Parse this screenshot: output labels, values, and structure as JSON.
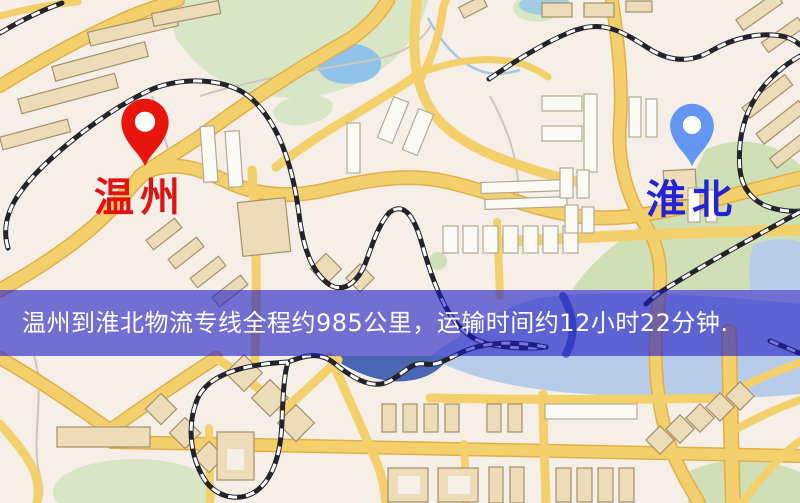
{
  "map": {
    "pins": {
      "origin": {
        "label": "温州",
        "label_color": "#e21212",
        "pin_color": "#e9140c"
      },
      "destination": {
        "label": "淮北",
        "label_color": "#2424d6",
        "pin_color": "#6495f1"
      }
    },
    "banner": {
      "text": "温州到淮北物流专线全程约985公里，运输时间约12小时22分钟.",
      "background_color": "#1919c4",
      "background_opacity": "0.60",
      "text_color": "#ffffff"
    },
    "route_summary": {
      "origin": "温州",
      "destination": "淮北",
      "distance_text": "全程约985公里",
      "duration_text": "运输时间约12小时22分钟"
    },
    "palette": {
      "background": "#f5efe7",
      "road": "#f4d06c",
      "road_casing": "#e2ae49",
      "park": "#d9e6c5",
      "water_lake": "#8fc3ea",
      "water_pale": "#b7cce9",
      "river": "#4a66b5",
      "railway": "#23232a",
      "building": "#ecdcb8",
      "building_white": "#fbfaf5"
    }
  }
}
